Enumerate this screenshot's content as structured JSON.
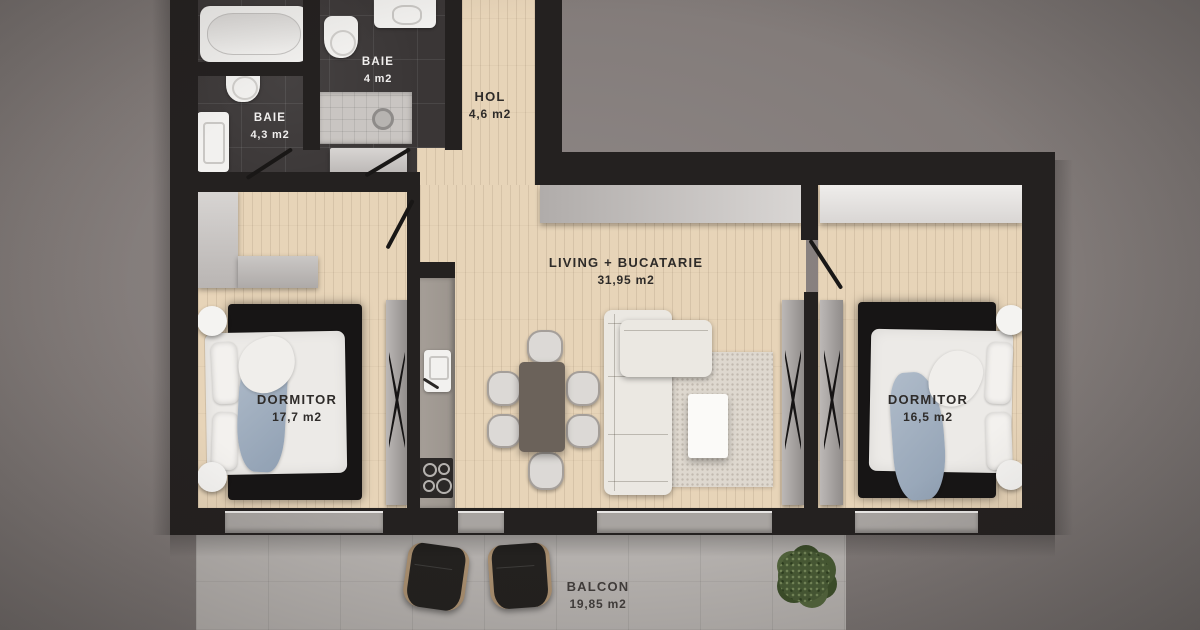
{
  "rooms": {
    "baie_small": {
      "name": "BAIE",
      "area": "4 m2"
    },
    "baie_big": {
      "name": "BAIE",
      "area": "4,3 m2"
    },
    "hol": {
      "name": "HOL",
      "area": "4,6 m2"
    },
    "living": {
      "name": "LIVING + BUCATARIE",
      "area": "31,95 m2"
    },
    "dormitor_left": {
      "name": "DORMITOR",
      "area": "17,7 m2"
    },
    "dormitor_right": {
      "name": "DORMITOR",
      "area": "16,5 m2"
    },
    "balcon": {
      "name": "BALCON",
      "area": "19,85 m2"
    }
  },
  "colors": {
    "bg": "#827b79",
    "wall": "#242120",
    "wood": "#e7d4b8",
    "tile": "#3a3636",
    "balcony": "#b5b1ae",
    "wardrobe": "#cdcac8",
    "bedwhite": "#eceae7",
    "bedblue": "#a3b1c2",
    "sofa": "#ebe8e2",
    "rugdark": "#171515",
    "ruglight": "#ded8cf",
    "table": "#6b625a",
    "counter": "#9b948d",
    "plant": "#475934",
    "labeldark": "#2e2b29",
    "labellight": "#f1efee"
  }
}
